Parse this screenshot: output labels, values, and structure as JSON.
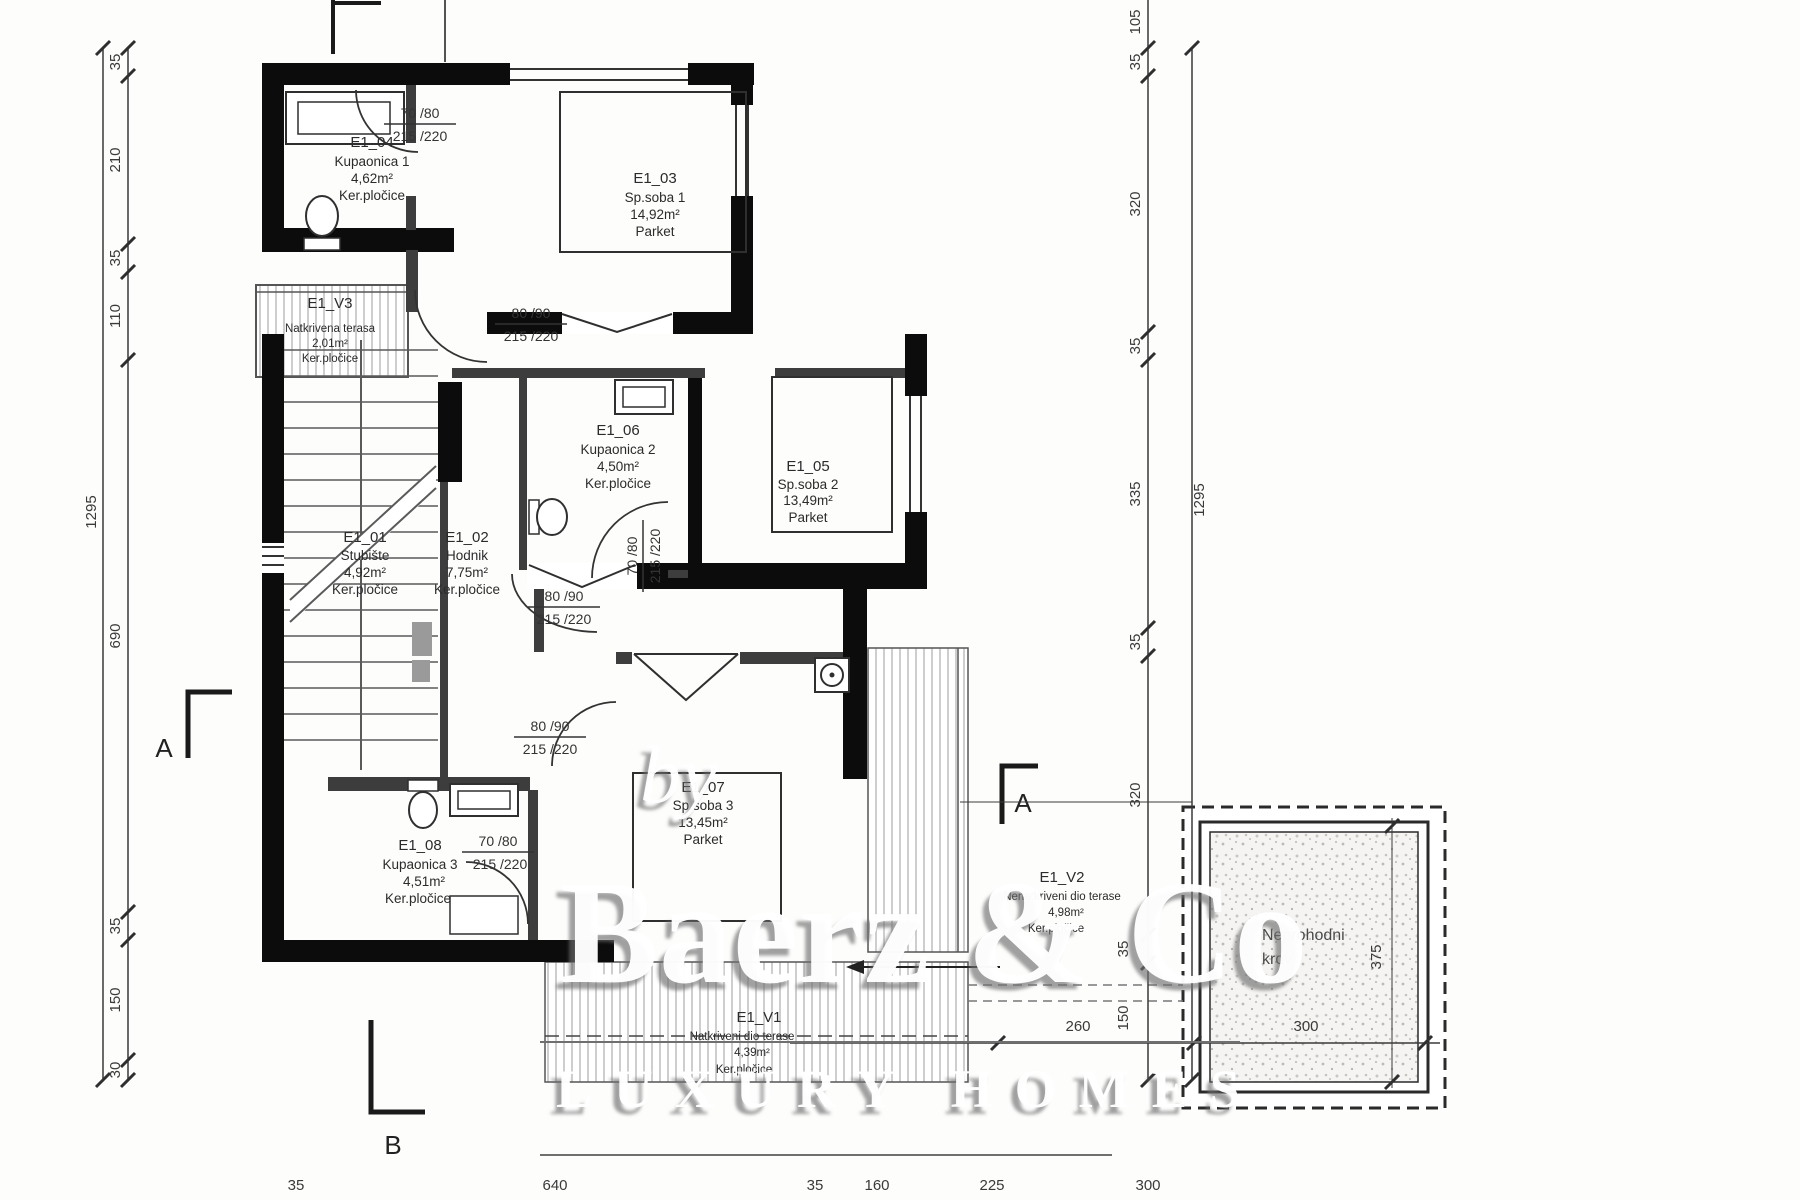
{
  "plan": {
    "rooms": [
      {
        "id": "E1_01",
        "name": "Stubište",
        "area": "4,92m²",
        "floor": "Ker.pločice"
      },
      {
        "id": "E1_02",
        "name": "Hodnik",
        "area": "7,75m²",
        "floor": "Ker.pločice"
      },
      {
        "id": "E1_03",
        "name": "Sp.soba 1",
        "area": "14,92m²",
        "floor": "Parket"
      },
      {
        "id": "E1_04",
        "name": "Kupaonica 1",
        "area": "4,62m²",
        "floor": "Ker.pločice"
      },
      {
        "id": "E1_05",
        "name": "Sp.soba 2",
        "area": "13,49m²",
        "floor": "Parket"
      },
      {
        "id": "E1_06",
        "name": "Kupaonica 2",
        "area": "4,50m²",
        "floor": "Ker.pločice"
      },
      {
        "id": "E1_07",
        "name": "Sp.soba 3",
        "area": "13,45m²",
        "floor": "Parket"
      },
      {
        "id": "E1_08",
        "name": "Kupaonica 3",
        "area": "4,51m²",
        "floor": "Ker.pločice"
      },
      {
        "id": "E1_V1",
        "name": "Natkriveni dio terase",
        "area": "4,39m²",
        "floor": "Ker.pločice"
      },
      {
        "id": "E1_V2",
        "name": "Nenatkriveni dio terase",
        "area": "4,98m²",
        "floor": "Ker.pločice"
      },
      {
        "id": "E1_V3",
        "name": "Natkrivena terasa",
        "area": "2,01m²",
        "floor": "Ker.pločice"
      }
    ],
    "roof": {
      "name1": "Neprohodni",
      "name2": "krov"
    },
    "doors": {
      "d7080": {
        "w": "70 /80",
        "h": "215 /220"
      },
      "d8090": {
        "w": "80 /90",
        "h": "215 /220"
      }
    },
    "sections": {
      "a": "A",
      "b": "B"
    },
    "dims": {
      "left_total": "1295",
      "left": [
        "35",
        "210",
        "35",
        "110",
        "690",
        "35",
        "150",
        "30"
      ],
      "right_top": "105",
      "right": [
        "35",
        "320",
        "35",
        "335",
        "35",
        "320",
        "35",
        "150"
      ],
      "right_total": "1295",
      "bottom": [
        "35",
        "640",
        "35",
        "160",
        "225",
        "300"
      ],
      "terrace": "260",
      "roof_w": "300",
      "roof_h": "375"
    }
  },
  "watermark": {
    "by": "by",
    "brand": "Baerz & Co",
    "tagline": "LUXURY HOMES"
  }
}
